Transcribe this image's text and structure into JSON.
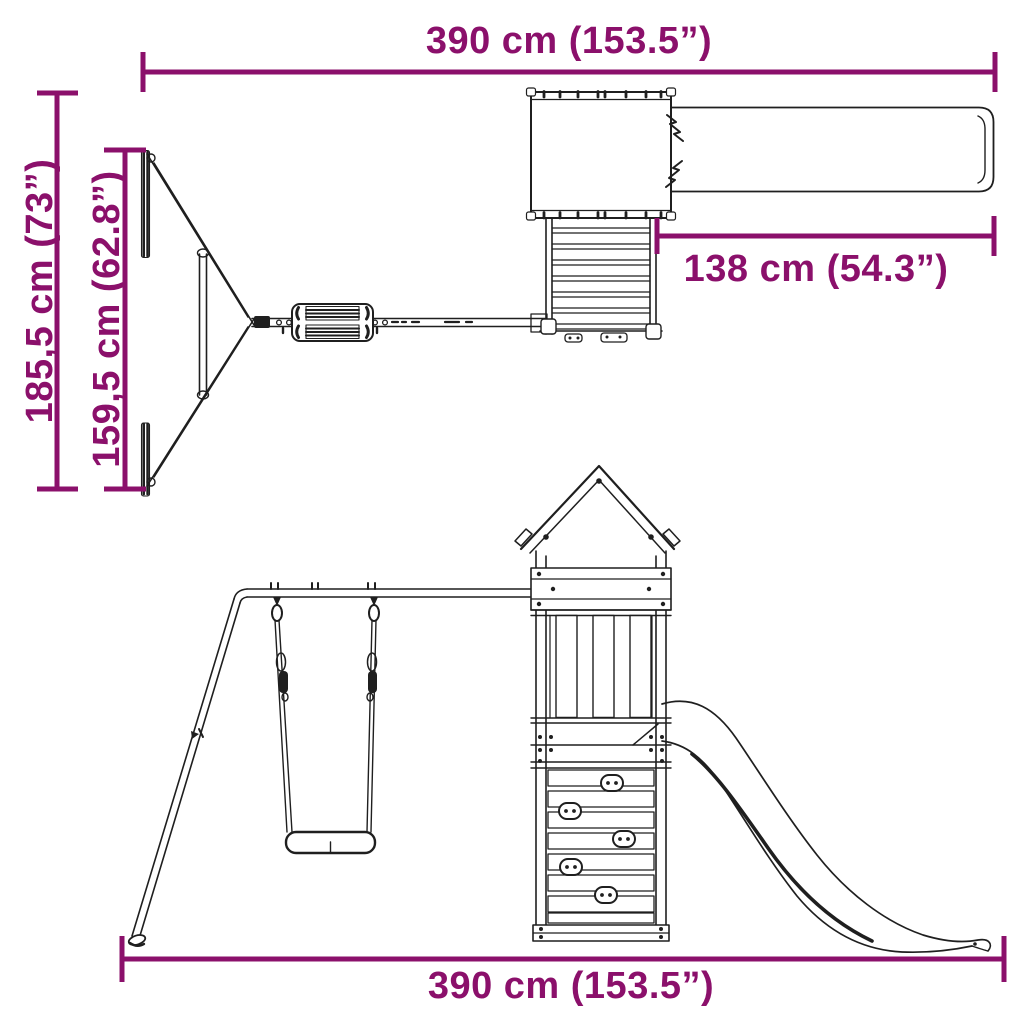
{
  "diagram": {
    "subject": "Wooden playset with swing, climbing tower and slide — dimension drawing (top view and front view)",
    "background_color": "#ffffff",
    "line_color": "#1f1f1f",
    "dimension_color": "#8B106B",
    "dimensions": {
      "top_width": {
        "label": "390 cm (153.5”)"
      },
      "overall_depth": {
        "label": "185,5 cm (73”)"
      },
      "swing_frame_depth": {
        "label": "159,5 cm (62.8”)"
      },
      "slide_length": {
        "label": "138 cm (54.3”)"
      },
      "bottom_width": {
        "label": "390 cm (153.5”)"
      }
    }
  }
}
